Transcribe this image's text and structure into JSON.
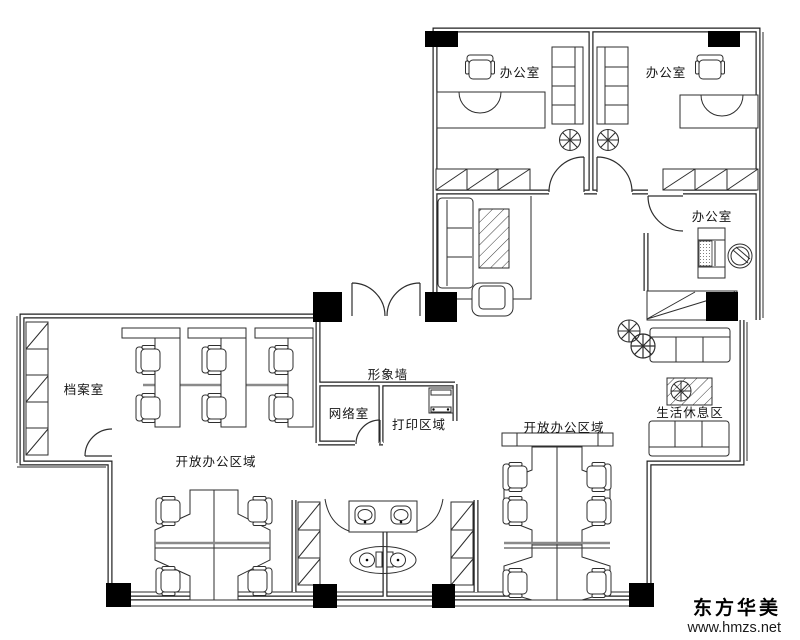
{
  "floor_plan": {
    "labels": {
      "office_top_left": "办公室",
      "office_top_right": "办公室",
      "office_right": "办公室",
      "archive_room": "档案室",
      "feature_wall": "形象墙",
      "network_room": "网络室",
      "print_area": "打印区域",
      "open_office_left": "开放办公区域",
      "open_office_bottom": "开放办公区域",
      "rest_area": "生活休息区"
    },
    "watermark": {
      "brand": "东方华美",
      "website": "www.hmzs.net"
    },
    "colors": {
      "background": "#ffffff",
      "line": "#1f1f1f",
      "column": "#000000"
    }
  }
}
